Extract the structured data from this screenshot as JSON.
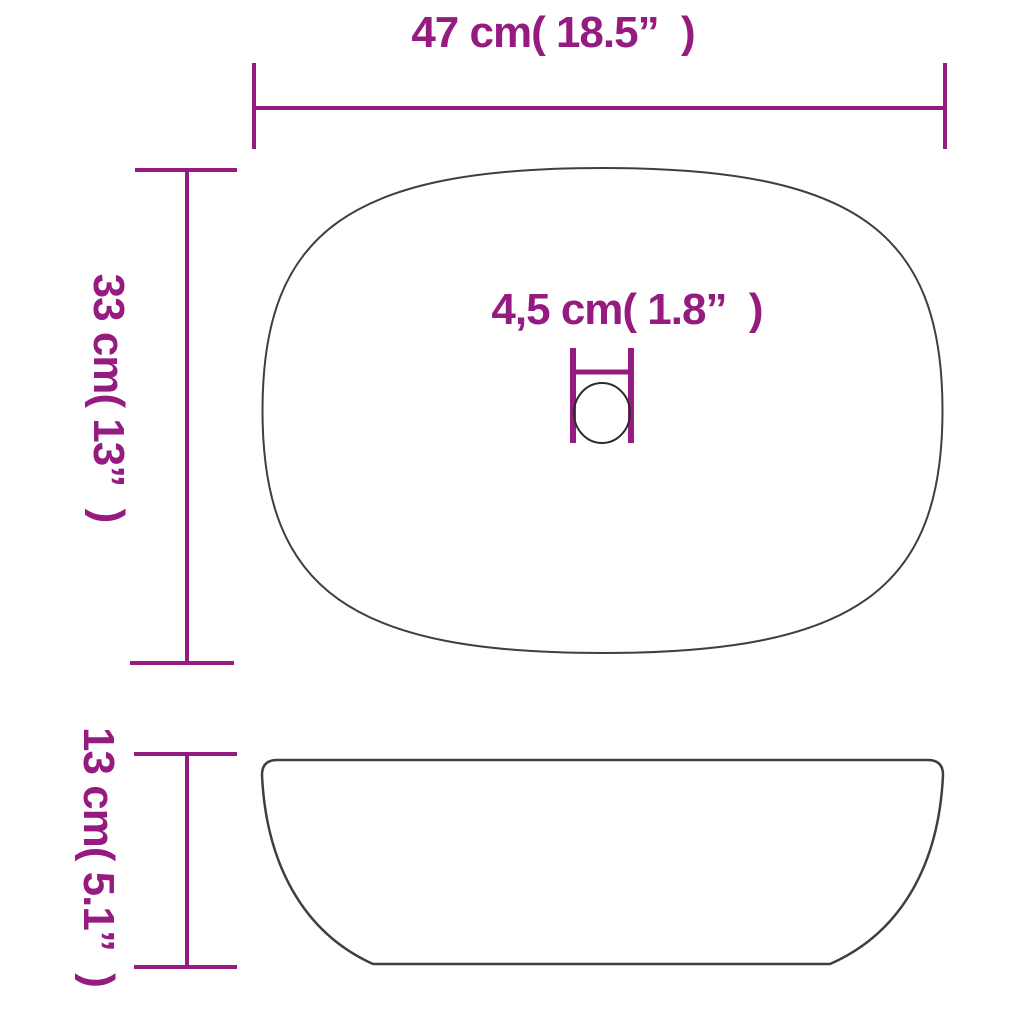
{
  "page": {
    "background": "#ffffff",
    "description": "Oval countertop wash basin dimension diagram, top view and side view"
  },
  "diagram": {
    "accent_color": "#951b81",
    "outline_color": "#3f3f3f",
    "labels": {
      "width": "47 cm( 18.5”  )",
      "height": "33 cm( 13”  )",
      "drain": "4,5 cm( 1.8”  )",
      "depth": "13 cm( 5.1”  )"
    },
    "values": {
      "width_cm": 47,
      "width_in": 18.5,
      "height_cm": 33,
      "height_in": 13,
      "drain_cm": "4,5",
      "drain_in": 1.8,
      "depth_cm": 13,
      "depth_in": 5.1
    }
  }
}
